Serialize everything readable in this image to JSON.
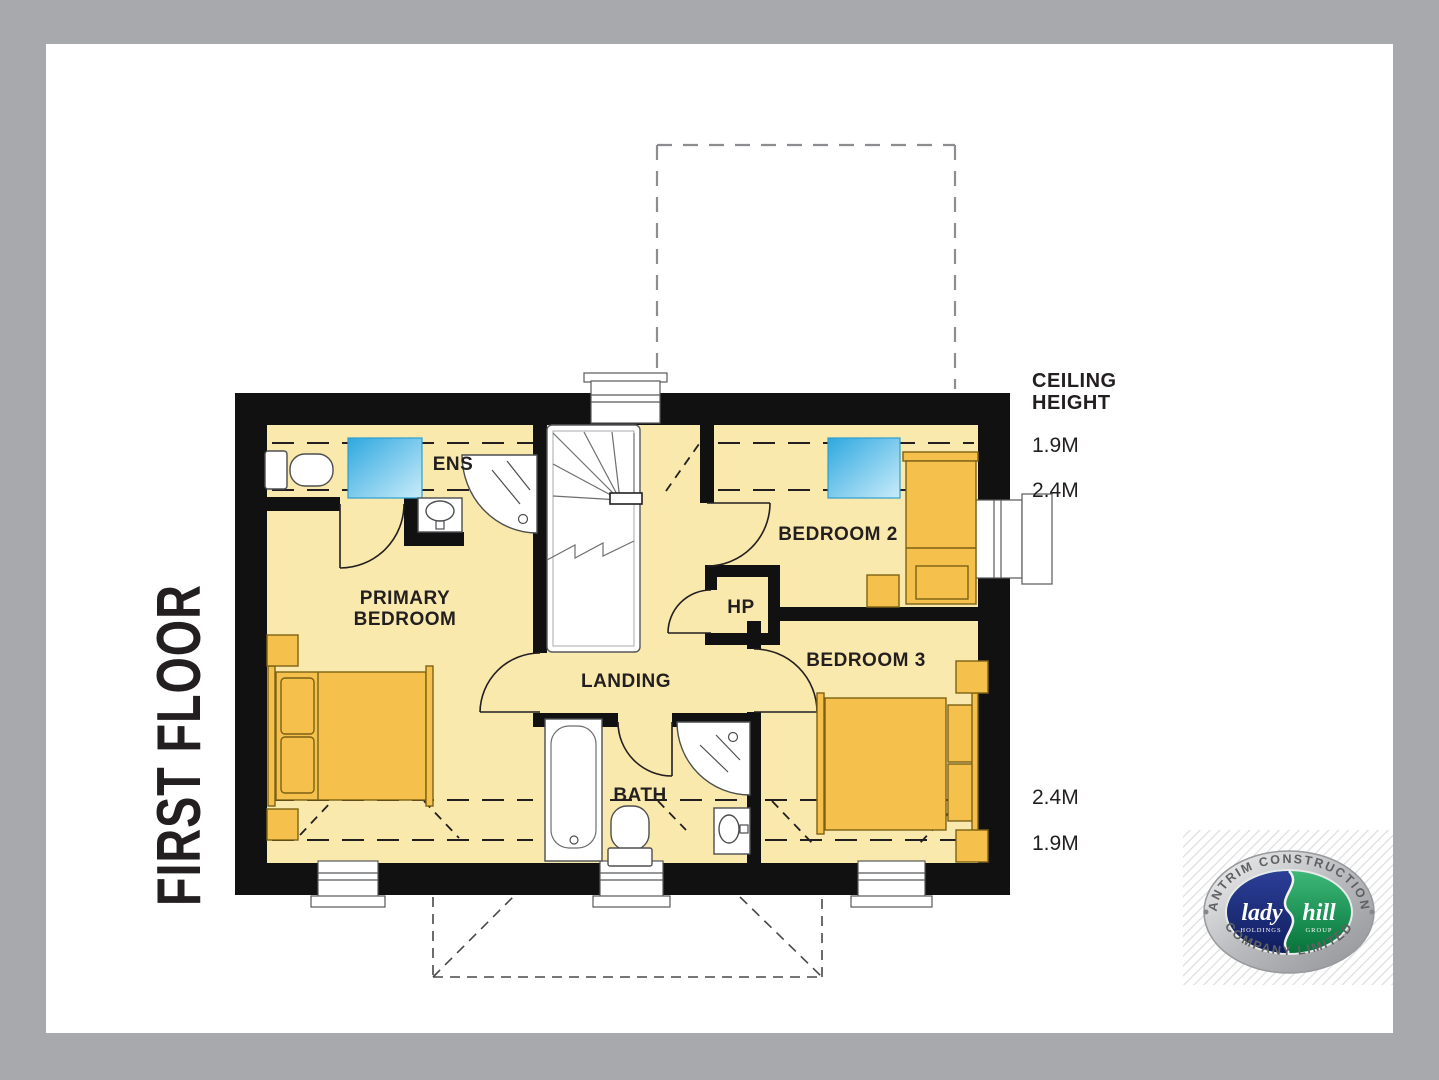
{
  "title": "FIRST FLOOR",
  "plan": {
    "labels": {
      "ens": "ENS",
      "primary_line1": "PRIMARY",
      "primary_line2": "BEDROOM",
      "landing": "LANDING",
      "hp": "HP",
      "bedroom2": "BEDROOM 2",
      "bedroom3": "BEDROOM 3",
      "bath": "BATH"
    }
  },
  "ceiling": {
    "title_line1": "CEILING",
    "title_line2": "HEIGHT",
    "upper": [
      "1.9M",
      "2.4M"
    ],
    "lower": [
      "2.4M",
      "1.9M"
    ]
  },
  "logo": {
    "arc_top": "ANTRIM CONSTRUCTION",
    "arc_bottom": "COMPANY LIMITED",
    "left_word": "lady",
    "left_sub": "HOLDINGS",
    "right_word": "hill",
    "right_sub": "GROUP"
  },
  "colors": {
    "background": "#a7a9ac",
    "paper": "#ffffff",
    "floor": "#fae9ac",
    "wall": "#111111",
    "furniture": "#f6c04d",
    "skylight_blue": "#29abe2",
    "logo_blue": "#1d2f7d",
    "logo_green": "#0e8a45"
  }
}
